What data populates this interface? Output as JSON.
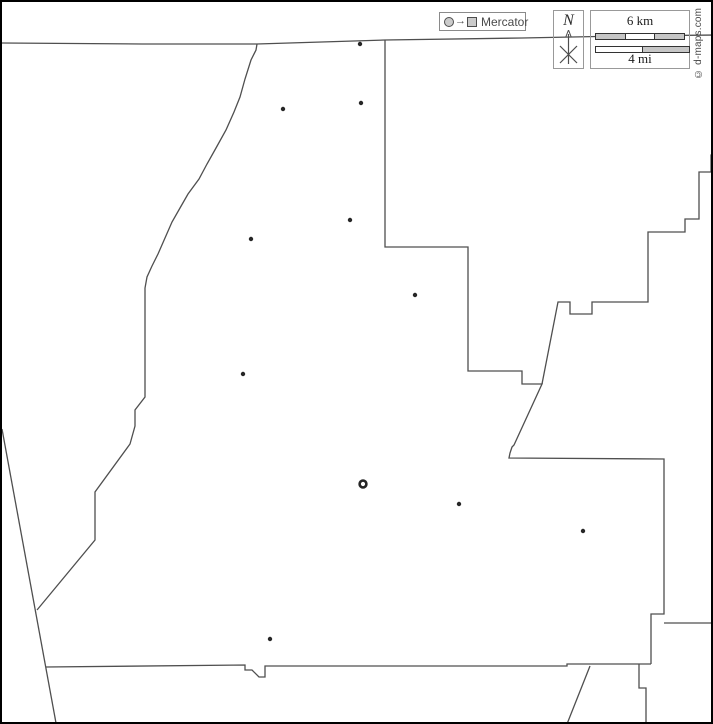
{
  "page": {
    "background": "#ffffff",
    "frame_color": "#000000"
  },
  "projection_legend": {
    "label": "Mercator",
    "arrow": "→",
    "symbol_fill": "#cbcbcb",
    "symbol_stroke": "#4d4d4d"
  },
  "compass": {
    "label": "N"
  },
  "scale": {
    "km_label": "6 km",
    "mi_label": "4 mi",
    "km_segments": [
      "#c6c6c6",
      "#ffffff",
      "#c6c6c6"
    ],
    "mi_segments": [
      "#ffffff",
      "#c6c6c6"
    ],
    "bar_outline": "#333333"
  },
  "copyright": {
    "text": "© d-maps.com"
  },
  "map": {
    "stroke": "#4f4f4f",
    "stroke_width": 1.3,
    "dot_color": "#262626",
    "boundaries": [
      {
        "name": "north-line",
        "points": [
          [
            0,
            41
          ],
          [
            140,
            42
          ],
          [
            255,
            42
          ],
          [
            383,
            38
          ],
          [
            520,
            36
          ],
          [
            620,
            34
          ],
          [
            713,
            33
          ]
        ]
      },
      {
        "name": "west-boundary",
        "points": [
          [
            255,
            42
          ],
          [
            254,
            48
          ],
          [
            249,
            58
          ],
          [
            243,
            77
          ],
          [
            238,
            95
          ],
          [
            232,
            110
          ],
          [
            224,
            128
          ],
          [
            214,
            146
          ],
          [
            205,
            162
          ],
          [
            197,
            177
          ],
          [
            186,
            192
          ],
          [
            178,
            206
          ],
          [
            170,
            220
          ],
          [
            163,
            236
          ],
          [
            156,
            252
          ],
          [
            150,
            264
          ],
          [
            145,
            275
          ],
          [
            143,
            286
          ],
          [
            143,
            395
          ],
          [
            133,
            408
          ],
          [
            133,
            424
          ],
          [
            128,
            442
          ],
          [
            93,
            490
          ],
          [
            93,
            538
          ],
          [
            35,
            608
          ]
        ]
      },
      {
        "name": "west-diagonal",
        "points": [
          [
            0,
            427
          ],
          [
            54,
            721
          ]
        ]
      },
      {
        "name": "south-boundary",
        "points": [
          [
            44,
            665
          ],
          [
            243,
            663
          ],
          [
            243,
            668
          ],
          [
            250,
            668
          ],
          [
            257,
            675
          ],
          [
            263,
            675
          ],
          [
            263,
            664
          ],
          [
            565,
            664
          ],
          [
            565,
            662
          ],
          [
            649,
            662
          ]
        ]
      },
      {
        "name": "east-boundary",
        "points": [
          [
            383,
            38
          ],
          [
            383,
            245
          ],
          [
            466,
            245
          ],
          [
            466,
            369
          ],
          [
            520,
            369
          ],
          [
            520,
            382
          ],
          [
            540,
            382
          ],
          [
            512,
            443
          ],
          [
            510,
            445
          ],
          [
            508,
            451
          ],
          [
            507,
            456
          ],
          [
            662,
            457
          ],
          [
            662,
            612
          ],
          [
            649,
            612
          ],
          [
            649,
            662
          ]
        ]
      },
      {
        "name": "northeast-neighbor",
        "points": [
          [
            540,
            382
          ],
          [
            556,
            300
          ],
          [
            568,
            300
          ],
          [
            568,
            312
          ],
          [
            590,
            312
          ],
          [
            590,
            300
          ],
          [
            646,
            300
          ],
          [
            646,
            230
          ],
          [
            683,
            230
          ],
          [
            683,
            217
          ],
          [
            697,
            217
          ],
          [
            697,
            170
          ],
          [
            709,
            170
          ],
          [
            709,
            153
          ],
          [
            713,
            153
          ]
        ]
      },
      {
        "name": "east-line",
        "points": [
          [
            662,
            621
          ],
          [
            713,
            621
          ]
        ]
      },
      {
        "name": "southeast-neighbor",
        "points": [
          [
            637,
            662
          ],
          [
            637,
            686
          ],
          [
            644,
            686
          ],
          [
            644,
            722
          ]
        ]
      },
      {
        "name": "south-diagonal",
        "points": [
          [
            588,
            664
          ],
          [
            565,
            722
          ]
        ]
      }
    ],
    "towns": [
      {
        "x": 358,
        "y": 42
      },
      {
        "x": 359,
        "y": 101
      },
      {
        "x": 281,
        "y": 107
      },
      {
        "x": 348,
        "y": 218
      },
      {
        "x": 249,
        "y": 237
      },
      {
        "x": 413,
        "y": 293
      },
      {
        "x": 241,
        "y": 372
      },
      {
        "x": 457,
        "y": 502
      },
      {
        "x": 581,
        "y": 529
      },
      {
        "x": 268,
        "y": 637
      }
    ],
    "county_seat": {
      "x": 361,
      "y": 482
    }
  }
}
